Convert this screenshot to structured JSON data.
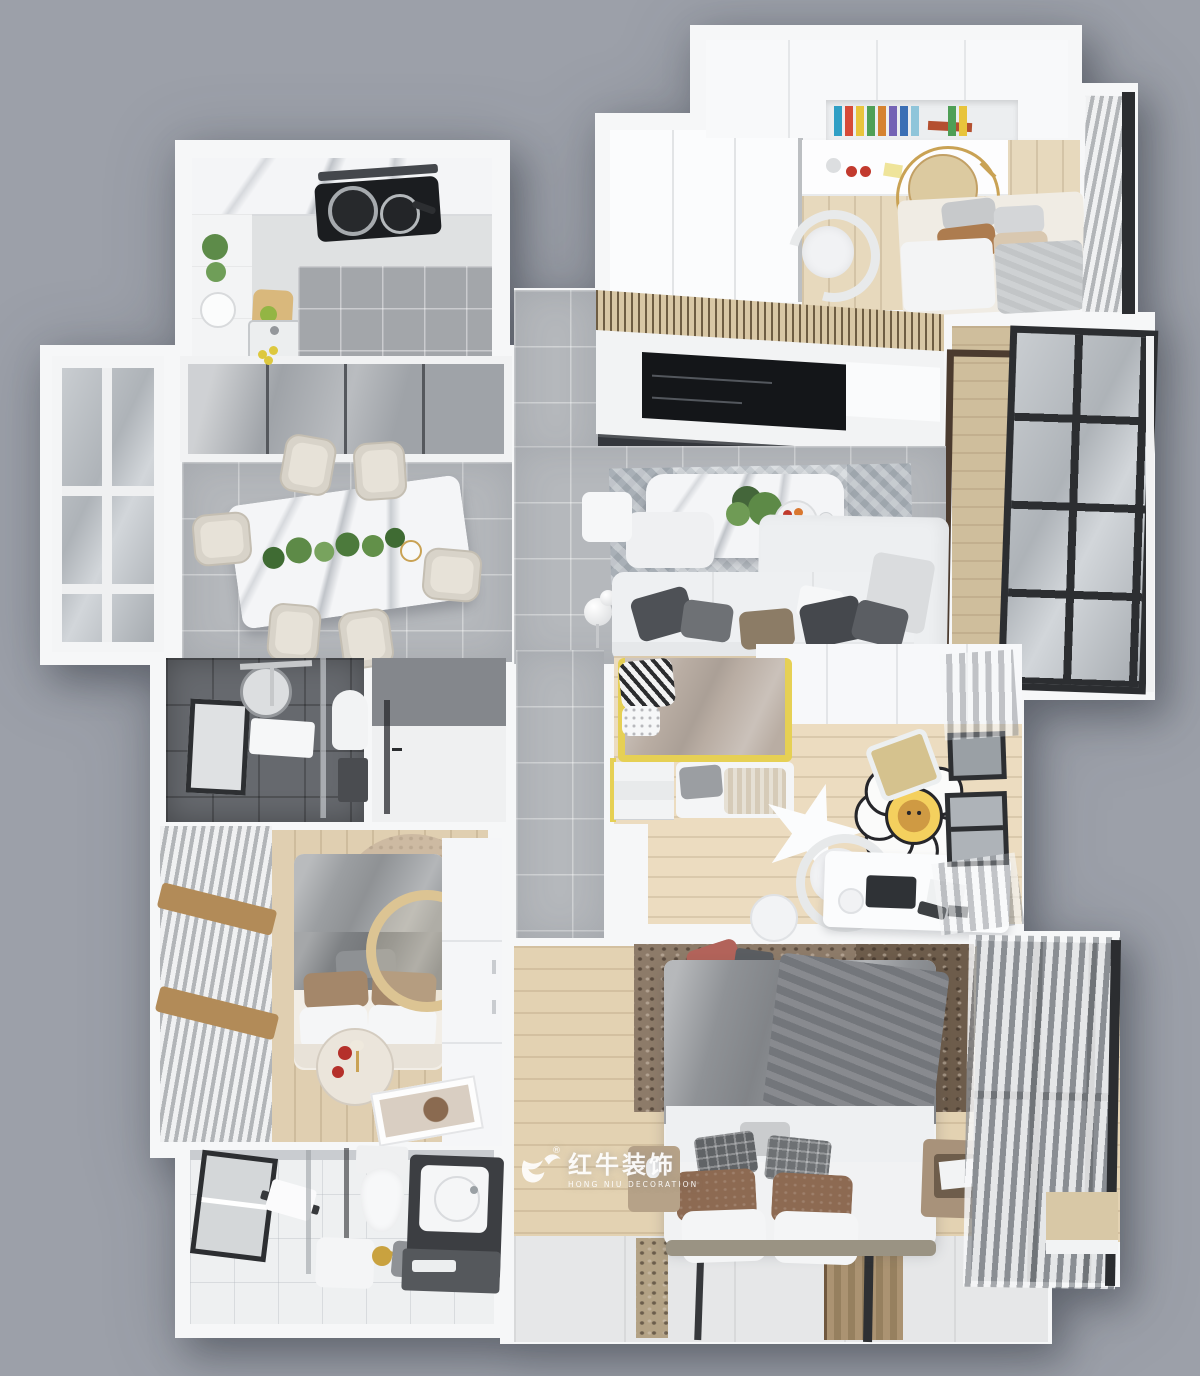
{
  "image": {
    "kind": "3D interior floor plan render, top-down dollhouse view",
    "width_px": 1200,
    "height_px": 1376,
    "background_color": "#9ca0a9"
  },
  "watermark": {
    "brand": "红牛装饰",
    "subtitle": "HONG NIU DECORATION",
    "registered": "®",
    "logo": "bull-icon",
    "text_color": "#ffffff"
  },
  "palette": {
    "background": "#9ca0a9",
    "wall": "#f6f7f8",
    "gray_tile": "#b5b8bc",
    "dark_tile": "#66696e",
    "wood_floor": "#e2d2b4",
    "kids_wood": "#ecdcc0",
    "balcony_wood": "#cfbe9c",
    "tv_black": "#141619",
    "media_console": "#34373c",
    "slat_wood": "#d8c7a5",
    "accent_yellow": "#e6d054",
    "gold": "#c9a254",
    "sofa_white": "#eef0f1",
    "marble_white": "#f4f5f7",
    "curtain_gray": "#b2b5b8",
    "window_frame": "#2b2d30",
    "master_rug": "#8d7b69",
    "brown_pillow": "#8d6a52",
    "red_accent": "#b5302a"
  },
  "scene": {
    "style": "modern white / gray / light-wood apartment, three bedrooms two bathrooms",
    "rooms": [
      {
        "name": "kitchen",
        "position": "top-left",
        "floor": "white cabinets + gray tile",
        "items": [
          "range-hood-bar",
          "gas-cooktop",
          "two-pots",
          "left-cabinet-run",
          "sink",
          "lemons",
          "potted-herbs",
          "serving-plate",
          "cutting-board"
        ]
      },
      {
        "name": "entry-hallway",
        "position": "top-center",
        "floor": "gray tile",
        "items": [
          "pendant-light"
        ]
      },
      {
        "name": "study-bedroom",
        "position": "top-right",
        "floor": "light wood",
        "items": [
          "walk-in-closet",
          "upper-cabinets",
          "bookshelf-niche",
          "desk",
          "desk-chair",
          "gold-side-table",
          "single-bed",
          "pillows",
          "window-curtain",
          "window-bar"
        ]
      },
      {
        "name": "dining-room",
        "position": "mid-left",
        "floor": "gray tile",
        "items": [
          "bay-window",
          "mirrored-sliding-closet",
          "marble-dining-table",
          "table-greenery",
          "gold-bowl",
          "six-dining-chairs"
        ]
      },
      {
        "name": "living-room",
        "position": "center",
        "floor": "gray tile + herringbone rug",
        "items": [
          "wood-slat-ceiling",
          "tv-panel",
          "media-console",
          "marble-coffee-table",
          "plant-centerpiece",
          "fruit-plate",
          "side-cube-table",
          "sphere-floor-lamp",
          "l-shaped-sofa",
          "throw-pillows"
        ]
      },
      {
        "name": "balcony",
        "position": "right",
        "floor": "wood planks",
        "items": [
          "dark-door-frame",
          "full-height-window",
          "window-sill"
        ]
      },
      {
        "name": "shower-bathroom",
        "position": "mid-left-lower",
        "floor": "dark gray tile",
        "items": [
          "framed-window",
          "round-mirror",
          "shower-set",
          "towel",
          "glass-partition",
          "toilet",
          "dark-shelf"
        ]
      },
      {
        "name": "storage-room",
        "position": "center-lower",
        "floor": "white",
        "items": [
          "dark-feature-wall",
          "glass-door"
        ]
      },
      {
        "name": "second-bedroom",
        "position": "left-lower",
        "floor": "light wood",
        "items": [
          "striped-curtain-window",
          "wood-valance-bands",
          "arch-rug",
          "double-bed",
          "gray-blanket",
          "brown-pillows",
          "white-pillows",
          "round-gold-mirror",
          "round-side-table",
          "red-decor",
          "gold-lamp",
          "wardrobe",
          "floor-artwork"
        ]
      },
      {
        "name": "master-bathroom",
        "position": "bottom-left",
        "floor": "white marble",
        "items": [
          "framed-window",
          "towel-rack",
          "glass-partition",
          "toilet",
          "storage-stool",
          "gold-kettle",
          "basket",
          "vanity-basin",
          "lower-shelf"
        ]
      },
      {
        "name": "kids-room",
        "position": "mid-right",
        "floor": "light wood",
        "items": [
          "wardrobe-run",
          "loft-bed-yellow-frame",
          "zebra-pillow",
          "white-pillow",
          "bed-stairs",
          "lower-bunk-bedding",
          "star-table",
          "flower-lion-rug",
          "lounge-cushion-chair",
          "desk",
          "laptop",
          "desk-lamp",
          "papers",
          "desk-chair",
          "round-stool",
          "upper-window",
          "lower-window",
          "sheer-curtains",
          "slippers"
        ]
      },
      {
        "name": "master-bedroom",
        "position": "bottom-right",
        "floor": "light wood + sliding-door bay",
        "items": [
          "speckled-rug",
          "red-cushion",
          "double-bed",
          "gray-duvet",
          "dark-throw",
          "plaid-pillows",
          "brown-pillows",
          "white-pillows",
          "nightstand-left",
          "figurine",
          "nightstand-right",
          "open-shelf-book",
          "sheer-curtain-window",
          "window-mullions",
          "window-bench",
          "sliding-door-tracks",
          "door-runner-panels"
        ]
      }
    ]
  }
}
